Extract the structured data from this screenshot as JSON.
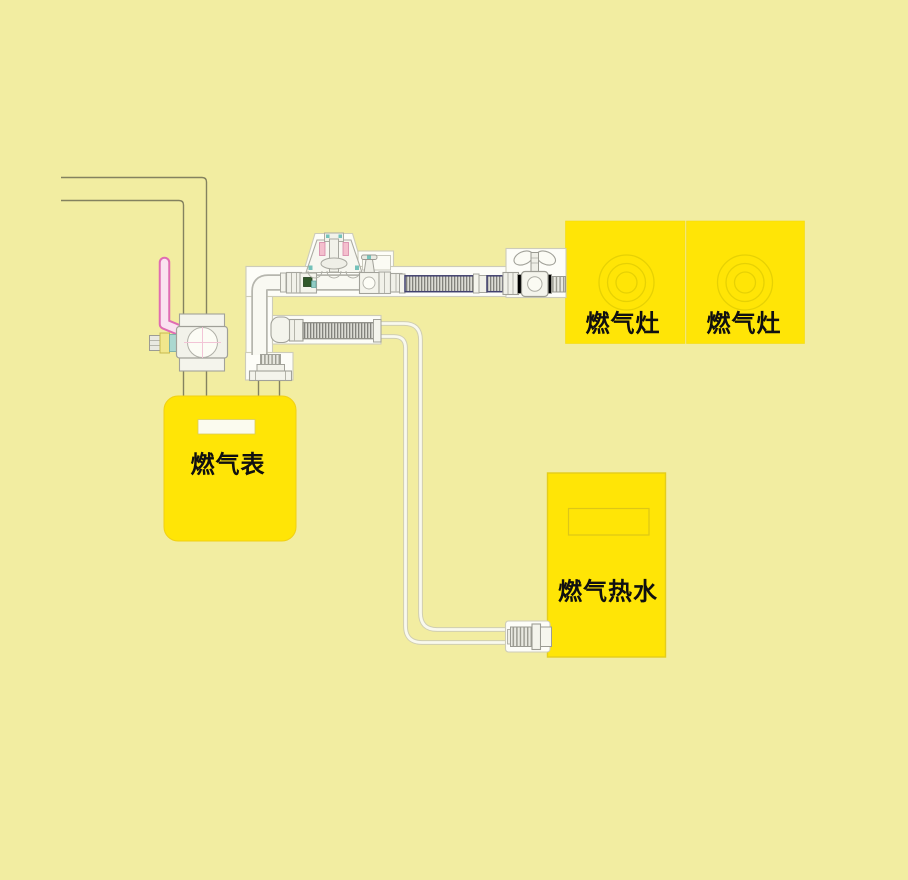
{
  "diagram": {
    "description": "Household gas piping installation diagram",
    "equipment": {
      "gas_meter": {
        "label": "燃气表"
      },
      "stove_left": {
        "label": "燃气灶"
      },
      "stove_right": {
        "label": "燃气灶"
      },
      "water_heater": {
        "label": "燃气热水"
      }
    },
    "colors": {
      "background": "#f2eda1",
      "equipment_yellow": "#ffe506",
      "equipment_border": "#e4cd1a",
      "wall_line_olive": "#84825f",
      "metal_outline": "#a2a29a",
      "metal_fill": "#f4f4ec",
      "hose_stripe_navy": "#40406e",
      "valve_handle_pink": "#e06cb2",
      "accent_teal": "#74c2ba",
      "accent_green": "#30582a",
      "accent_spring_pink": "#f4bfcd"
    }
  }
}
